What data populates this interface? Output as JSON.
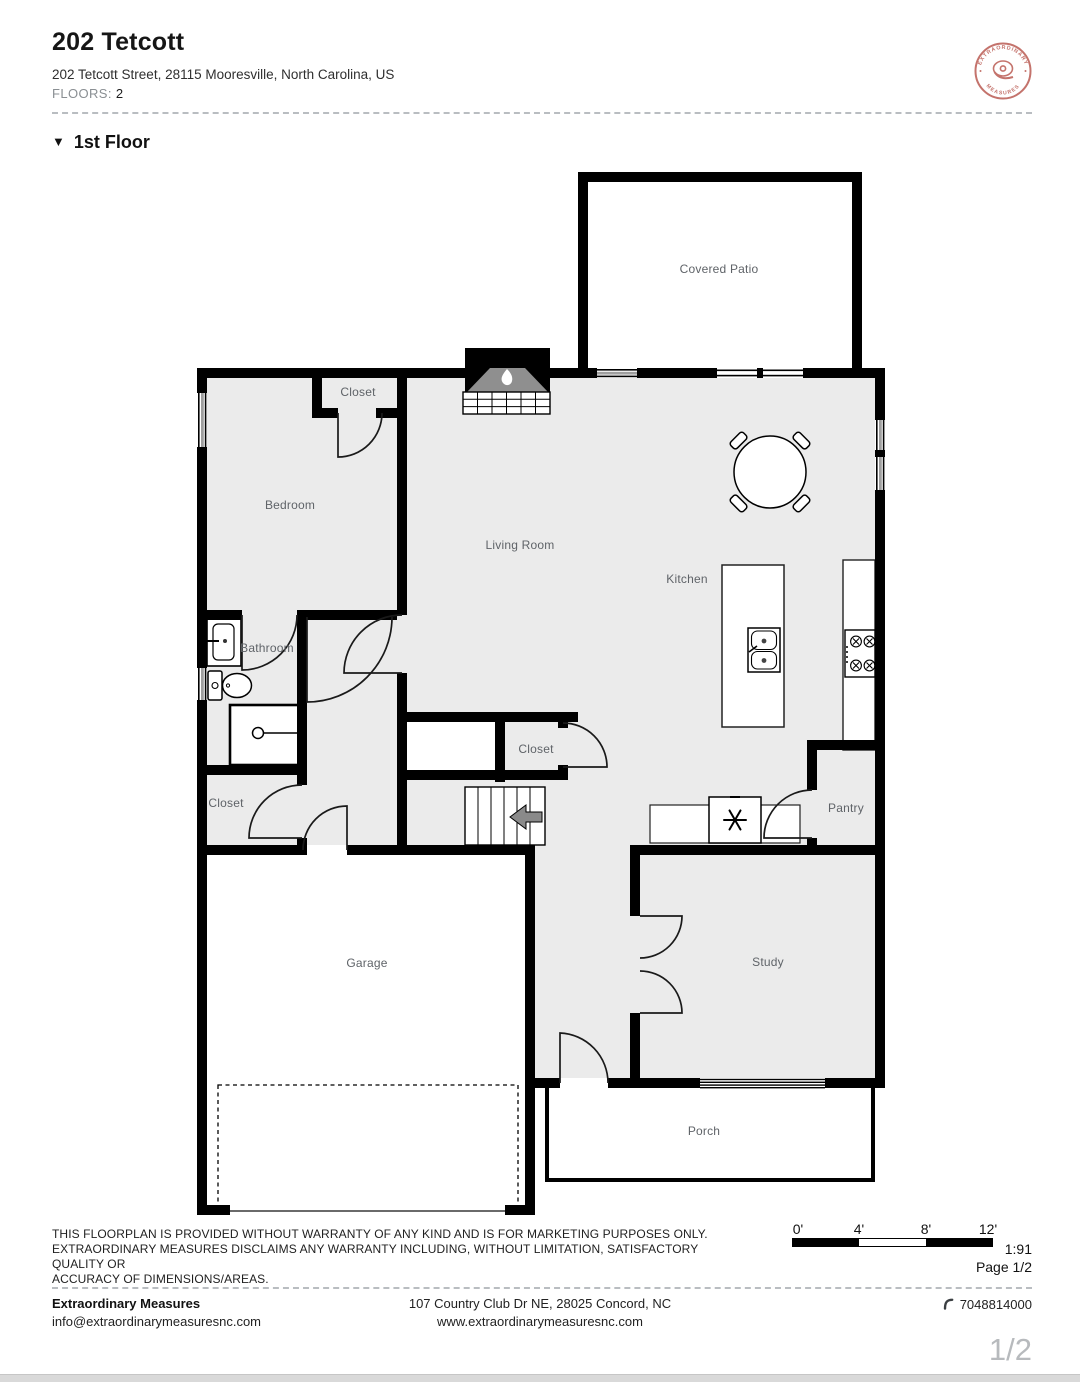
{
  "theme": {
    "wall": "#000000",
    "floor": "#ebebeb",
    "label": "#5f6368",
    "accent": "#c4736c",
    "page-bg": "#ffffff"
  },
  "header": {
    "title": "202 Tetcott",
    "address": "202 Tetcott Street, 28115 Mooresville, North Carolina, US",
    "floors_label": "FLOORS:",
    "floors_value": "2"
  },
  "logo": {
    "arc_top": "EXTRAORDINARY",
    "arc_bottom": "MEASURES"
  },
  "section": {
    "marker": "▼",
    "title": "1st Floor"
  },
  "floorplan": {
    "rooms": [
      {
        "name": "covered-patio",
        "label": "Covered Patio"
      },
      {
        "name": "closet-bedroom",
        "label": "Closet"
      },
      {
        "name": "bedroom",
        "label": "Bedroom"
      },
      {
        "name": "living-room",
        "label": "Living Room"
      },
      {
        "name": "kitchen",
        "label": "Kitchen"
      },
      {
        "name": "bathroom",
        "label": "Bathroom"
      },
      {
        "name": "closet-hall",
        "label": "Closet"
      },
      {
        "name": "closet-entry",
        "label": "Closet"
      },
      {
        "name": "pantry",
        "label": "Pantry"
      },
      {
        "name": "garage",
        "label": "Garage"
      },
      {
        "name": "study",
        "label": "Study"
      },
      {
        "name": "porch",
        "label": "Porch"
      }
    ],
    "icons": {
      "fireplace": "flame",
      "fridge": "snowflake",
      "stairs": "left-arrow"
    }
  },
  "disclaimer": {
    "line1": "THIS FLOORPLAN IS PROVIDED WITHOUT WARRANTY OF ANY KIND AND IS FOR MARKETING PURPOSES ONLY.",
    "line2": "EXTRAORDINARY MEASURES DISCLAIMS ANY WARRANTY INCLUDING, WITHOUT LIMITATION, SATISFACTORY QUALITY OR",
    "line3": "ACCURACY OF DIMENSIONS/AREAS."
  },
  "scalebar": {
    "ticks": [
      "0'",
      "4'",
      "8'",
      "12'"
    ],
    "ratio": "1:91",
    "page_label": "Page 1/2"
  },
  "footer": {
    "company": "Extraordinary Measures",
    "email": "info@extraordinarymeasuresnc.com",
    "address": "107 Country Club Dr NE, 28025 Concord, NC",
    "website": "www.extraordinarymeasuresnc.com",
    "phone": "7048814000",
    "page_indicator": "1/2"
  }
}
